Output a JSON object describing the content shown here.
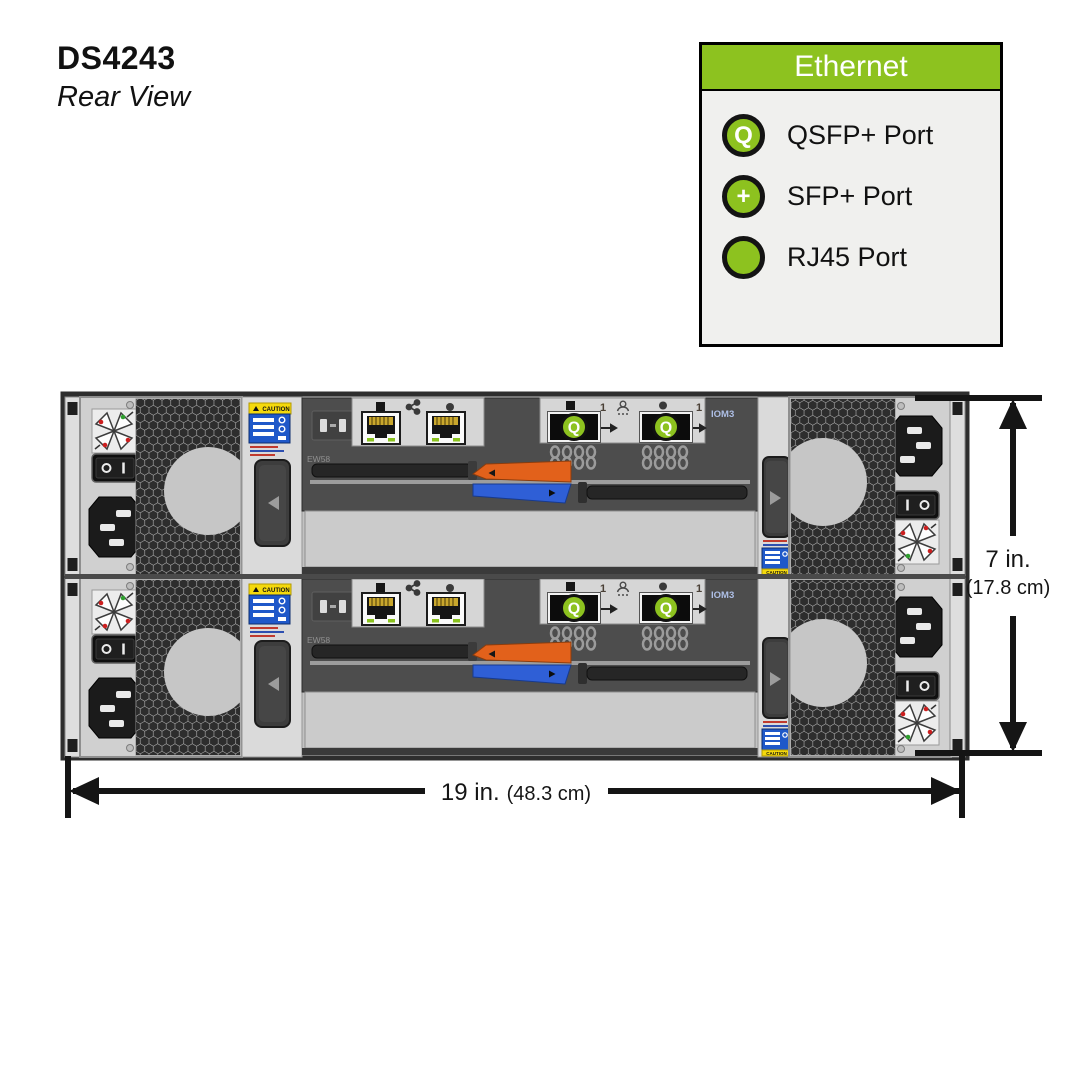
{
  "page": {
    "title": "DS4243",
    "subtitle": "Rear View"
  },
  "legend": {
    "header": "Ethernet",
    "items": [
      {
        "icon": "qsfp-port-icon",
        "symbol": "Q",
        "label": "QSFP+ Port"
      },
      {
        "icon": "sfp-port-icon",
        "symbol": "+",
        "label": "SFP+ Port"
      },
      {
        "icon": "rj45-port-icon",
        "symbol": "",
        "label": "RJ45 Port"
      }
    ]
  },
  "diagram": {
    "iom_label": "IOM3",
    "iom_code": "EW58",
    "qsfp_symbol": "Q",
    "port_indicator": "1",
    "caution_text": "CAUTION"
  },
  "dimensions": {
    "height": {
      "value": "7 in.",
      "metric": "(17.8 cm)"
    },
    "width": {
      "value": "19 in.",
      "metric": "(48.3 cm)"
    }
  },
  "colors": {
    "accent_green": "#8DC21F",
    "lever_orange": "#E2611B",
    "lever_blue": "#2F5FD6",
    "caution_yellow": "#F5D90C",
    "label_blue": "#1F58C9"
  }
}
